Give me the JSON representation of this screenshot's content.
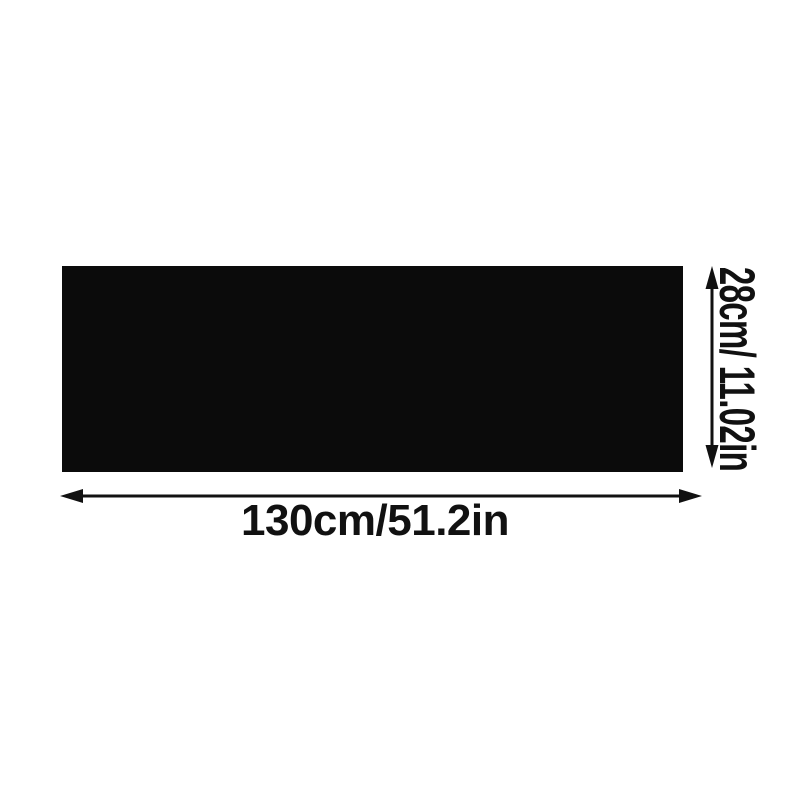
{
  "page": {
    "background_color": "#ffffff"
  },
  "diagram": {
    "product_fill": "#0b0b0b",
    "line_color": "#111111",
    "text_color": "#111111",
    "width_dimension": {
      "label": "130cm/51.2in"
    },
    "height_dimension": {
      "label": "28cm/ 11.02in"
    }
  }
}
